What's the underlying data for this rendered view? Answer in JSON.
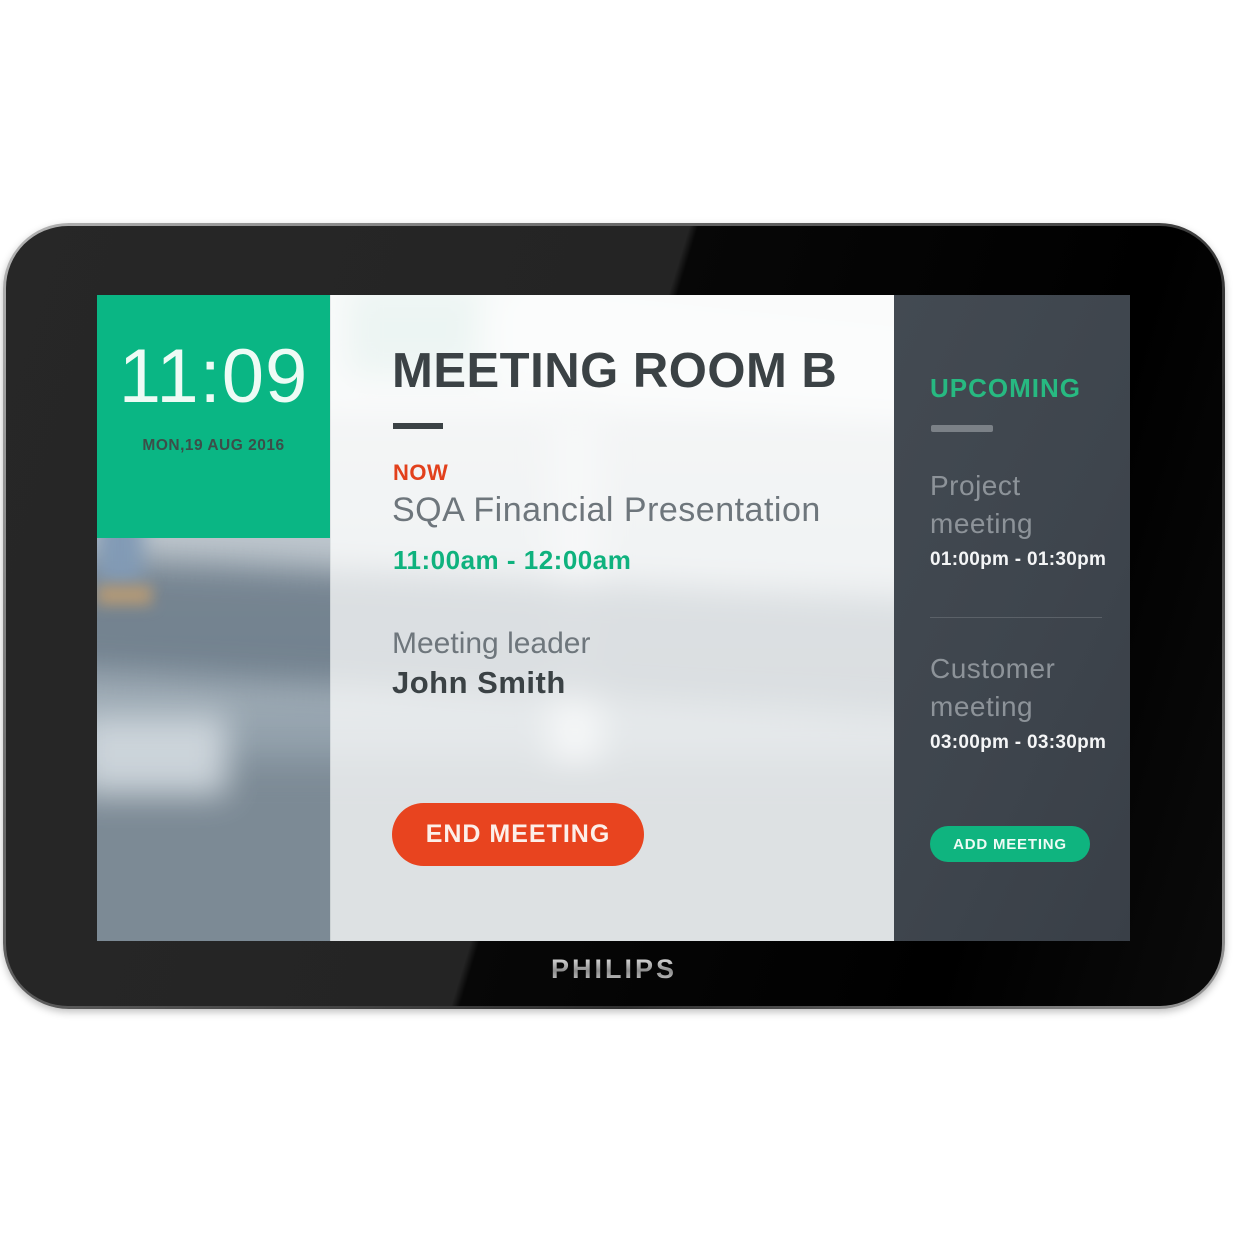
{
  "device": {
    "brand_logo": "PHILIPS"
  },
  "clock": {
    "time": "11:09",
    "date": "MON,19 AUG 2016"
  },
  "main": {
    "room_title": "MEETING ROOM B",
    "now_label": "NOW",
    "meeting_title": "SQA Financial Presentation",
    "meeting_time": "11:00am - 12:00am",
    "leader_label": "Meeting leader",
    "leader_name": "John Smith",
    "end_button": "END MEETING"
  },
  "sidebar": {
    "title": "UPCOMING",
    "events": [
      {
        "name": "Project meeting",
        "time": "01:00pm - 01:30pm"
      },
      {
        "name": "Customer meeting",
        "time": "03:00pm - 03:30pm"
      }
    ],
    "add_button": "ADD MEETING"
  },
  "colors": {
    "accent_green": "#0ab684",
    "accent_orange": "#e8441f",
    "sidebar_background": "#3e454d",
    "dark_text": "#3b4245"
  }
}
